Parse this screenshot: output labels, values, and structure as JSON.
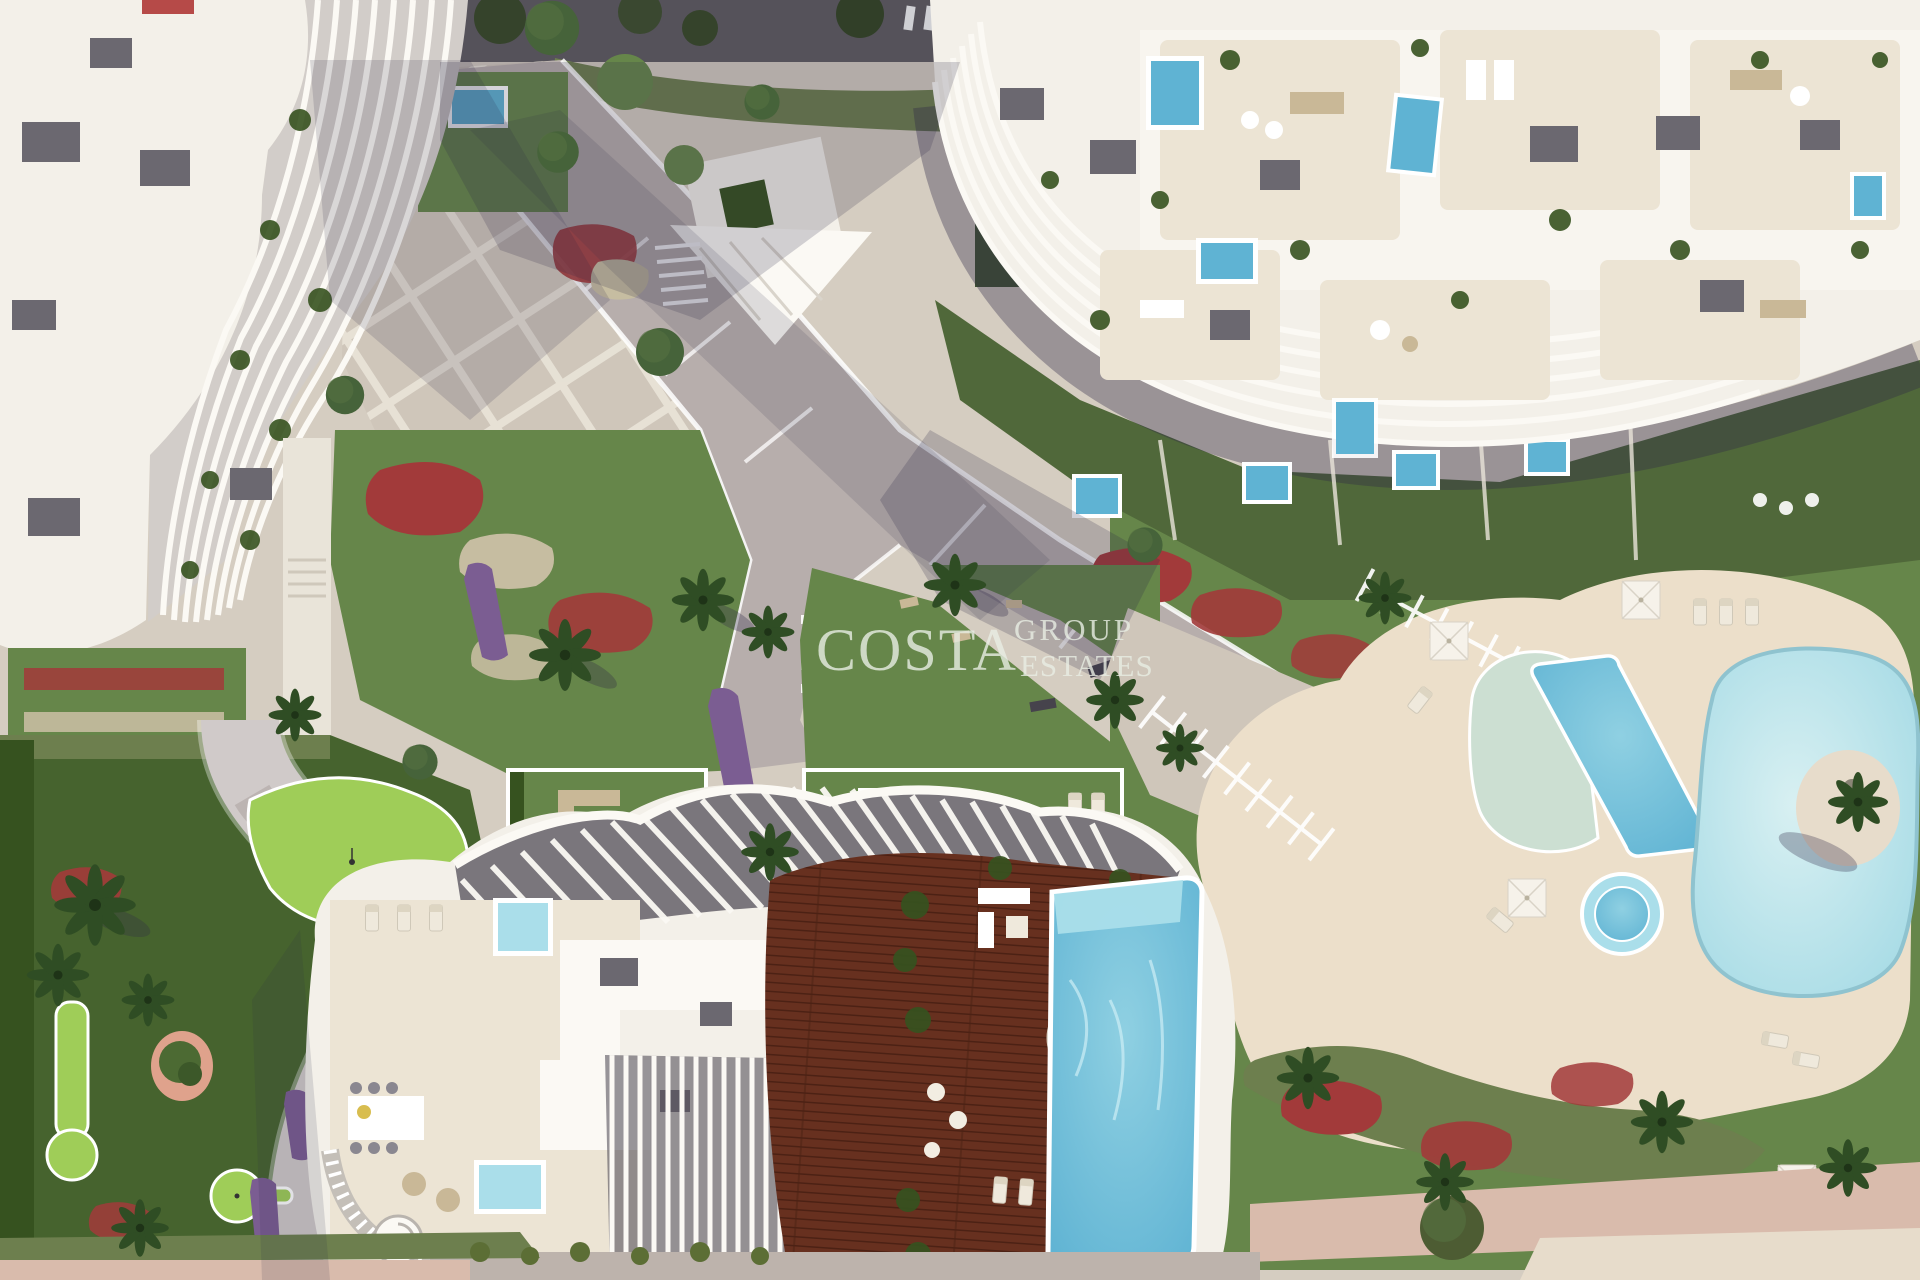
{
  "watermark": {
    "line1": "COSTA",
    "line2": "GROUP",
    "line3": "ESTATES"
  },
  "palette": {
    "base": "#d5cdc1",
    "plaza": "#cfc6ba",
    "promenade": "#b7aeac",
    "walk_white": "#e9e4d9",
    "road": "#55525a",
    "sand_deck": "#ecdfca",
    "sand_beach": "#e7dccb",
    "path_pink": "#d9bbac",
    "building": "#f3f0e9",
    "building_hi": "#fbf9f4",
    "terrace": "#ece4d4",
    "roof_unit": "#6b6870",
    "louver_gap": "#d2cdc9",
    "deck_wood": "#67301f",
    "deck_wood_dark": "#4c2114",
    "pool": "#5fb3d3",
    "pool_light": "#aadeea",
    "lagoon": "#a9dce6",
    "lagoon_light": "#d8f0f2",
    "pool_pale": "#ccdfd2",
    "grass": "#66864a",
    "grass_dark": "#46632e",
    "putting": "#9fcd58",
    "hedge": "#36521f",
    "hedge_flower": "#6d7f4e",
    "tree": "#46633a",
    "palm": "#2f4d24",
    "red": "#a23a3a",
    "red_bright": "#b64a48",
    "purple": "#7b5d92",
    "gravel": "#c6bda1",
    "planter_pink": "#dfa28c",
    "umbrella": "#f6f2ea",
    "furn_tan": "#c9b897",
    "furn_gray": "#8a8790",
    "shadow": "#2e2847",
    "watermark": "#e9eee4"
  }
}
